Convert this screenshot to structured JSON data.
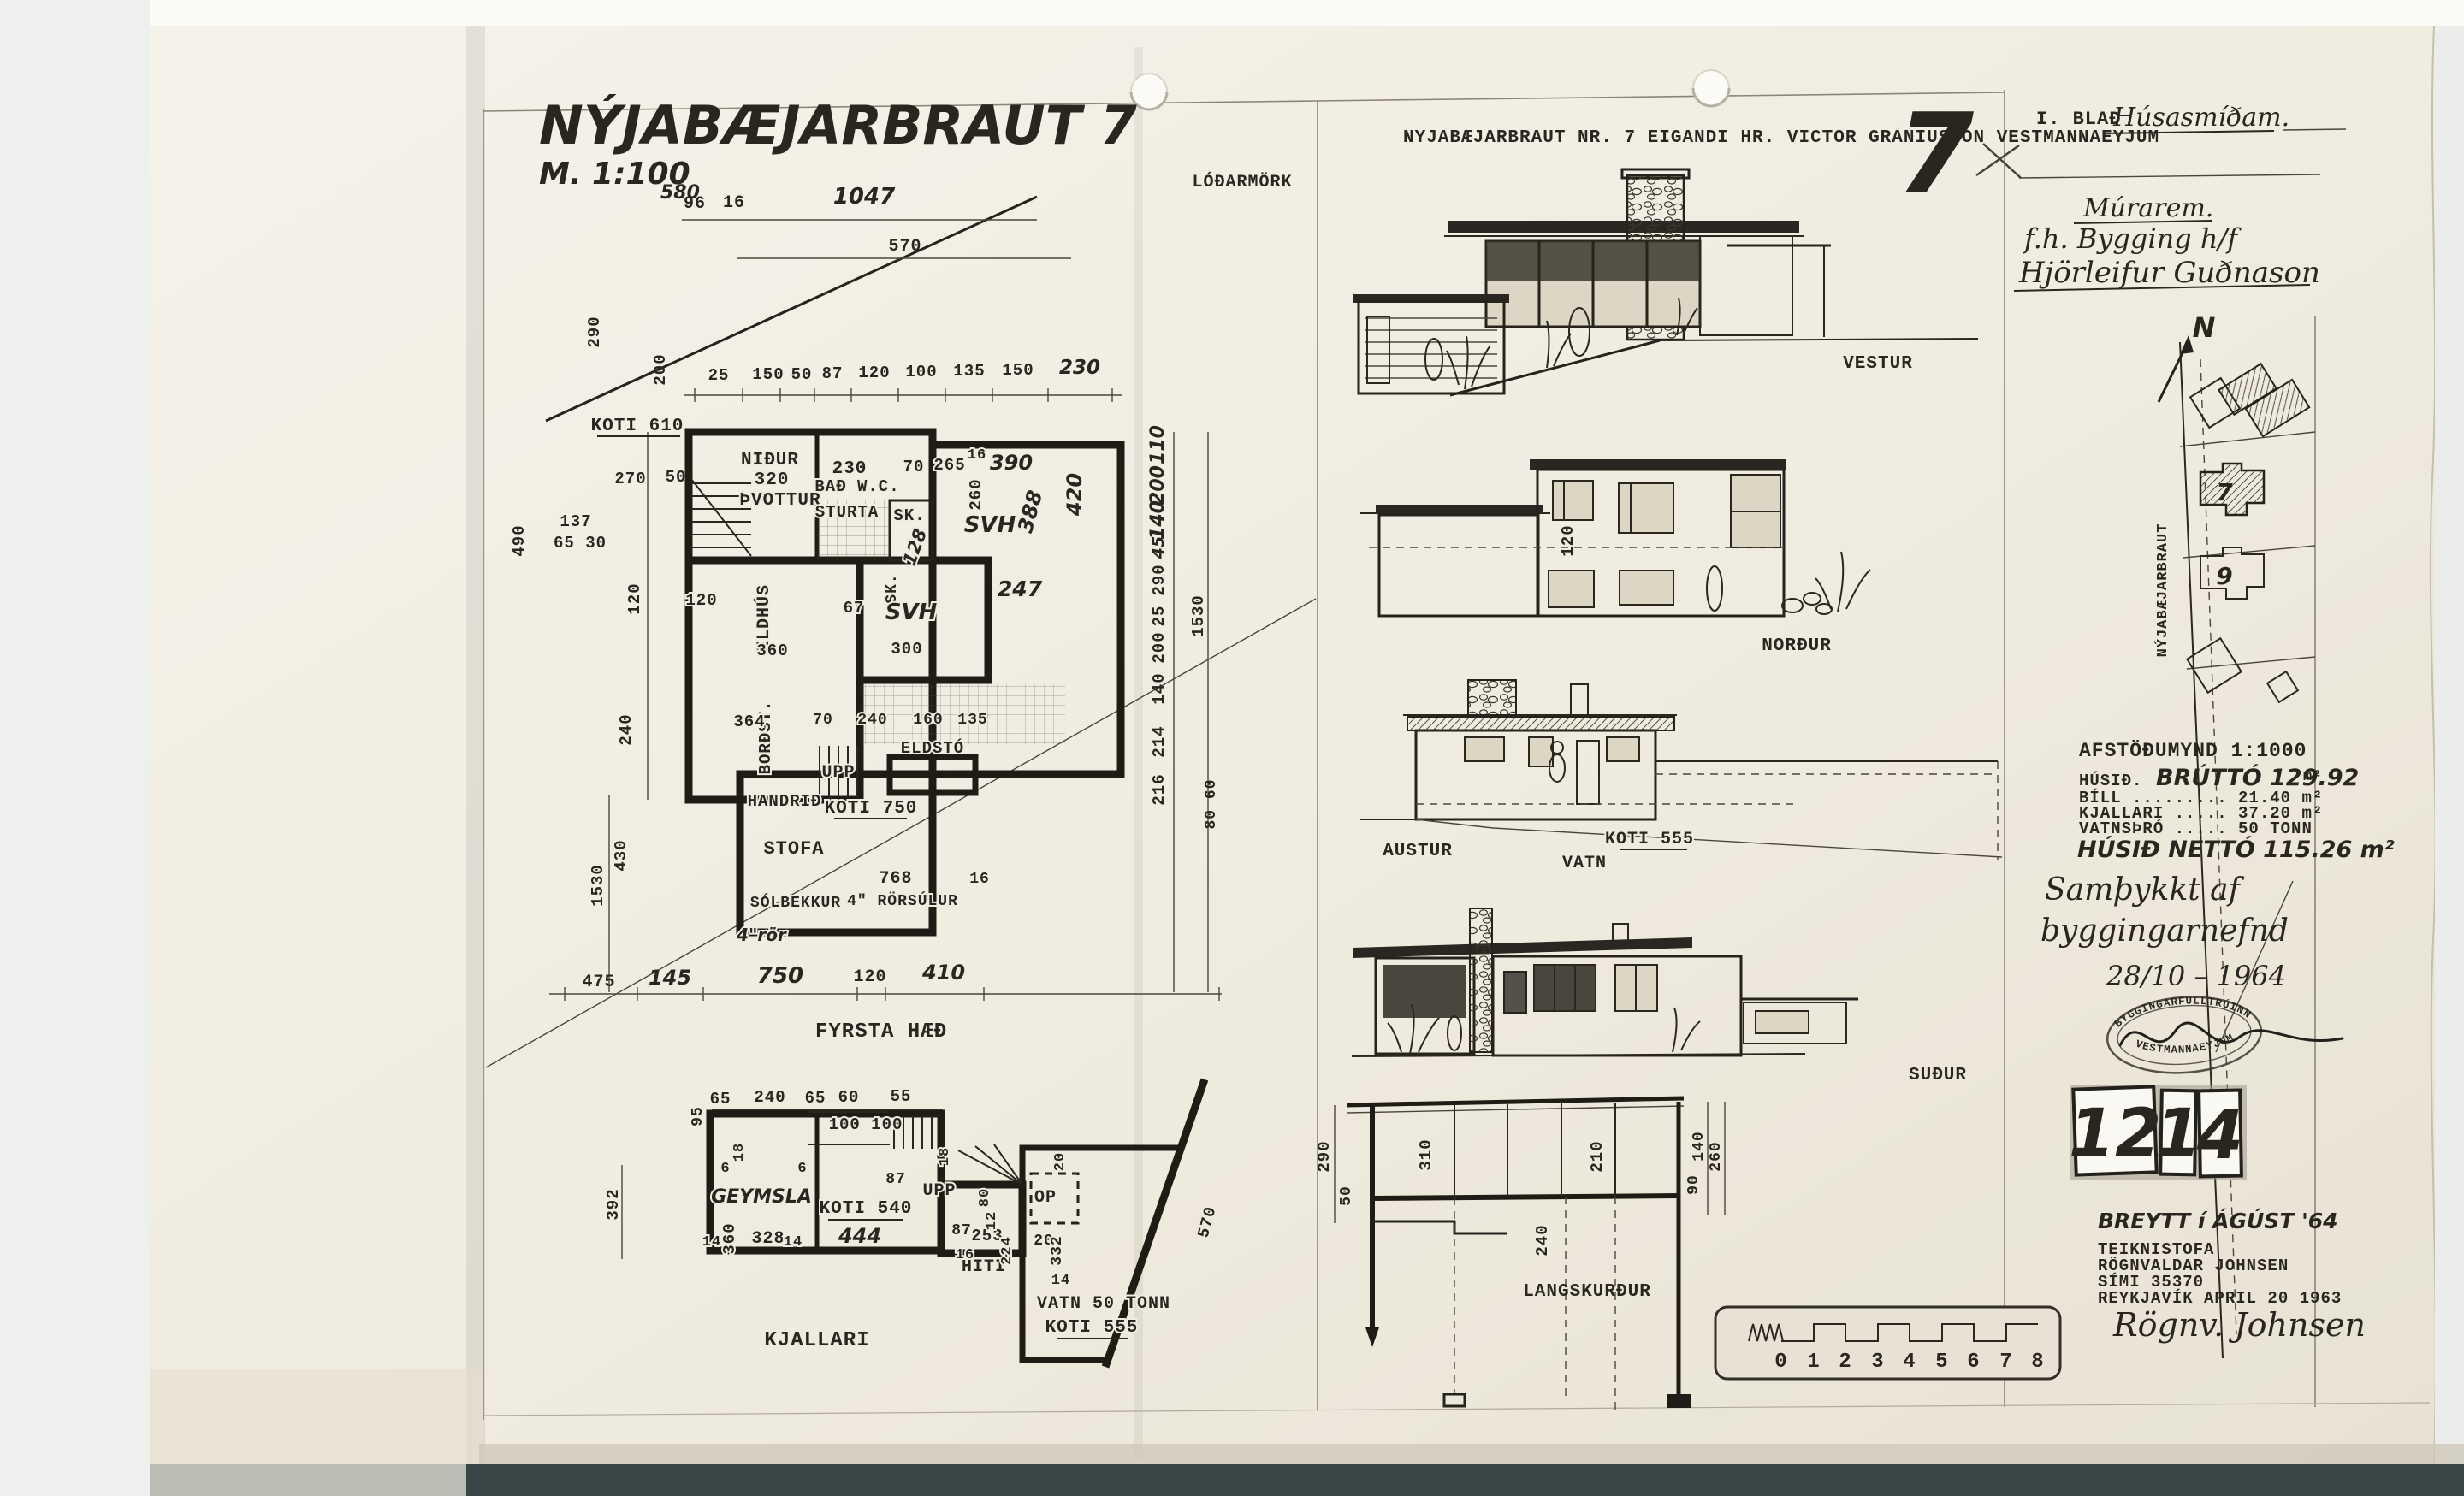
{
  "page": {
    "hand_title": "NÝJABÆJARBRAUT 7",
    "hand_scale": "M. 1:100",
    "hand_scale_sub": "580",
    "typed_header": "NYJABÆJARBRAUT NR. 7   EIGANDI HR. VICTOR GRANIUSSON   VESTMANNAEYJUM",
    "big_seven": "7",
    "lodarmork": "LÓÐARMÖRK"
  },
  "ff": {
    "name": "FYRSTA HÆÐ",
    "koti610": "KOTI 610",
    "koti750": "KOTI 750",
    "rooms": {
      "nidur": "NIÐUR",
      "nidur_dim": "320",
      "thvottur": "ÞVOTTUR",
      "bad": "BAÐ W.C.",
      "bad_dim": "230",
      "sturta": "STURTA",
      "sk1": "SK.",
      "sk2": "SK.",
      "svh1": "SVH",
      "svh2": "SVH",
      "eldhus": "ELDHÚS",
      "bordst": "BORÐST.",
      "upp": "UPP",
      "eldsto": "ELDSTÓ",
      "handrid": "HANDRIÐ",
      "stofa": "STOFA",
      "solbekkur": "SÓLBEKKUR",
      "rorsulur": "4\" RÖRSÚLUR",
      "ror": "4\"rör"
    },
    "upper": [
      "96",
      "16",
      "1047",
      "570"
    ],
    "row": [
      "25",
      "150",
      "50",
      "87",
      "120",
      "100",
      "135",
      "150",
      "230"
    ],
    "left": [
      "290",
      "200",
      "490",
      "137",
      "65 30",
      "270",
      "50",
      "120",
      "240",
      "430",
      "1530"
    ],
    "right": [
      "110",
      "200",
      "140",
      "45",
      "290",
      "25",
      "200",
      "140",
      "214",
      "216",
      "1530",
      "420",
      "80 60"
    ],
    "bottom": [
      "475",
      "145",
      "750",
      "120",
      "410"
    ],
    "inner": [
      "70",
      "265",
      "16",
      "390",
      "260",
      "388",
      "128",
      "247",
      "67",
      "360",
      "300",
      "120",
      "364",
      "768",
      "16",
      "70",
      "240",
      "160",
      "135"
    ]
  },
  "bm": {
    "name": "KJALLARI",
    "koti540": "KOTI 540",
    "koti555": "KOTI 555",
    "vatn": "VATN 50 TONN",
    "geymsla": "GEYMSLA",
    "hiti": "HITI",
    "op": "OP",
    "upp": "UPP",
    "top": [
      "65",
      "240",
      "65",
      "60",
      "55",
      "100  100"
    ],
    "dims": [
      "95",
      "392",
      "360",
      "328",
      "14",
      "14",
      "6",
      "6",
      "18",
      "444",
      "87",
      "87",
      "253",
      "16",
      "12",
      "80",
      "18",
      "224",
      "20",
      "332",
      "20",
      "14",
      "570"
    ]
  },
  "el": {
    "vestur": "VESTUR",
    "nordur": "NORÐUR",
    "austur": "AUSTUR",
    "sudur": "SUÐUR",
    "section": "LANGSKURÐUR",
    "n_dim": "120",
    "a_koti": "KOTI 555",
    "a_vatn": "VATN",
    "sec": [
      "290",
      "50",
      "310",
      "240",
      "210",
      "140",
      "90",
      "260"
    ]
  },
  "site": {
    "north": "N",
    "street": "NÝJABÆJARBRAUT",
    "lot7": "7",
    "lot9": "9"
  },
  "tb": {
    "blad_label": "I. BLAÐ",
    "blad_value": "Húsasmíðam.",
    "murarem": "Múrarem.",
    "fh": "f.h. Bygging h/f",
    "sig1": "Hjörleifur Guðnason",
    "afst": "AFSTÖÐUMYND 1:1000",
    "s1a": "HÚSIÐ.",
    "s1b": "BRÚTTÓ 129.92",
    "s1c": "m²",
    "s2": "BÍLL ......... 21.40 m²",
    "s3": "KJALLARI ..... 37.20 m²",
    "s4": "VATNSÞRÓ ..... 50 TONN",
    "s5": "HÚSIÐ NETTÓ 115.26 m²",
    "ap1": "Samþykkt af",
    "ap2": "byggingarnefnd",
    "ap3": "28/10 – 1964",
    "stamp_top": "BYGGINGARFULLTRÚINN",
    "stamp_bottom": "VESTMANNAEYJUM",
    "tiles": [
      "12",
      "1",
      "4"
    ],
    "breytt": "BREYTT í ÁGÚST '64",
    "firm": [
      "TEIKNISTOFA",
      "RÖGNVALDAR JOHNSEN",
      "SÍMI 35370",
      "REYKJAVÍK APRIL 20 1963"
    ],
    "sig2": "Rögnv. Johnsen"
  },
  "sb": {
    "ticks": [
      "0",
      "1",
      "2",
      "3",
      "4",
      "5",
      "6",
      "7",
      "8"
    ]
  }
}
